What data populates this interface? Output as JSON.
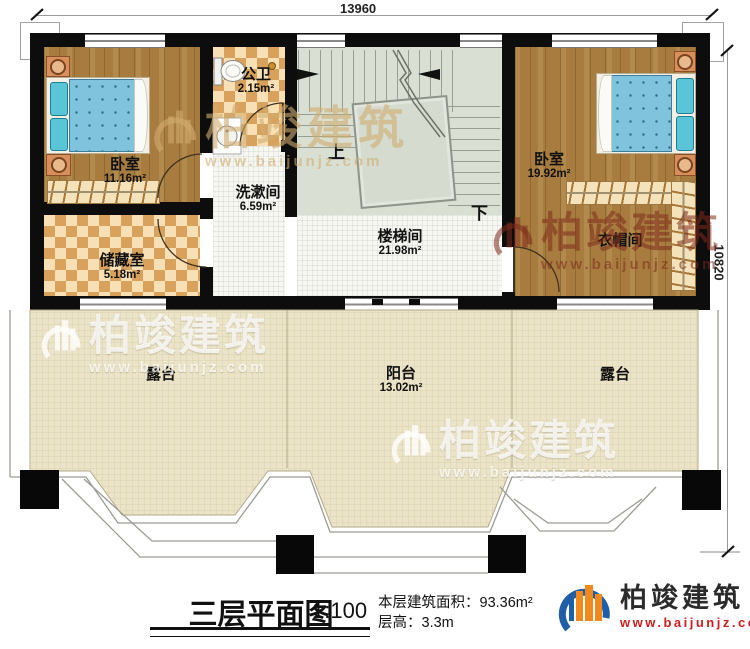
{
  "dimensions": {
    "width_mm": "13960",
    "height_mm": "10820"
  },
  "rooms": {
    "bedroom_left": {
      "name": "卧室",
      "area": "11.16m²"
    },
    "bathroom": {
      "name": "公卫",
      "area": "2.15m²"
    },
    "washroom": {
      "name": "洗漱间",
      "area": "6.59m²"
    },
    "storage": {
      "name": "储藏室",
      "area": "5.18m²"
    },
    "stairwell": {
      "name": "楼梯间",
      "area": "21.98m²"
    },
    "bedroom_right": {
      "name": "卧室",
      "area": "19.92m²"
    },
    "cloakroom": {
      "name": "衣帽间"
    },
    "terrace_left": {
      "name": "露台"
    },
    "balcony": {
      "name": "阳台",
      "area": "13.02m²"
    },
    "terrace_right": {
      "name": "露台"
    }
  },
  "stairs": {
    "up_label": "上",
    "down_label": "下"
  },
  "legend": {
    "title": "三层平面图",
    "scale": "1:100",
    "area_text": "本层建筑面积：93.36m²",
    "height_text": "层高：3.3m"
  },
  "brand": {
    "name": "柏竣建筑",
    "url": "www.baijunjz.com"
  },
  "colors": {
    "accent_blue": "#1f5fa8",
    "accent_orange": "#f08a1d",
    "url_red": "#cc2020",
    "wall": "#0d0d0d"
  }
}
